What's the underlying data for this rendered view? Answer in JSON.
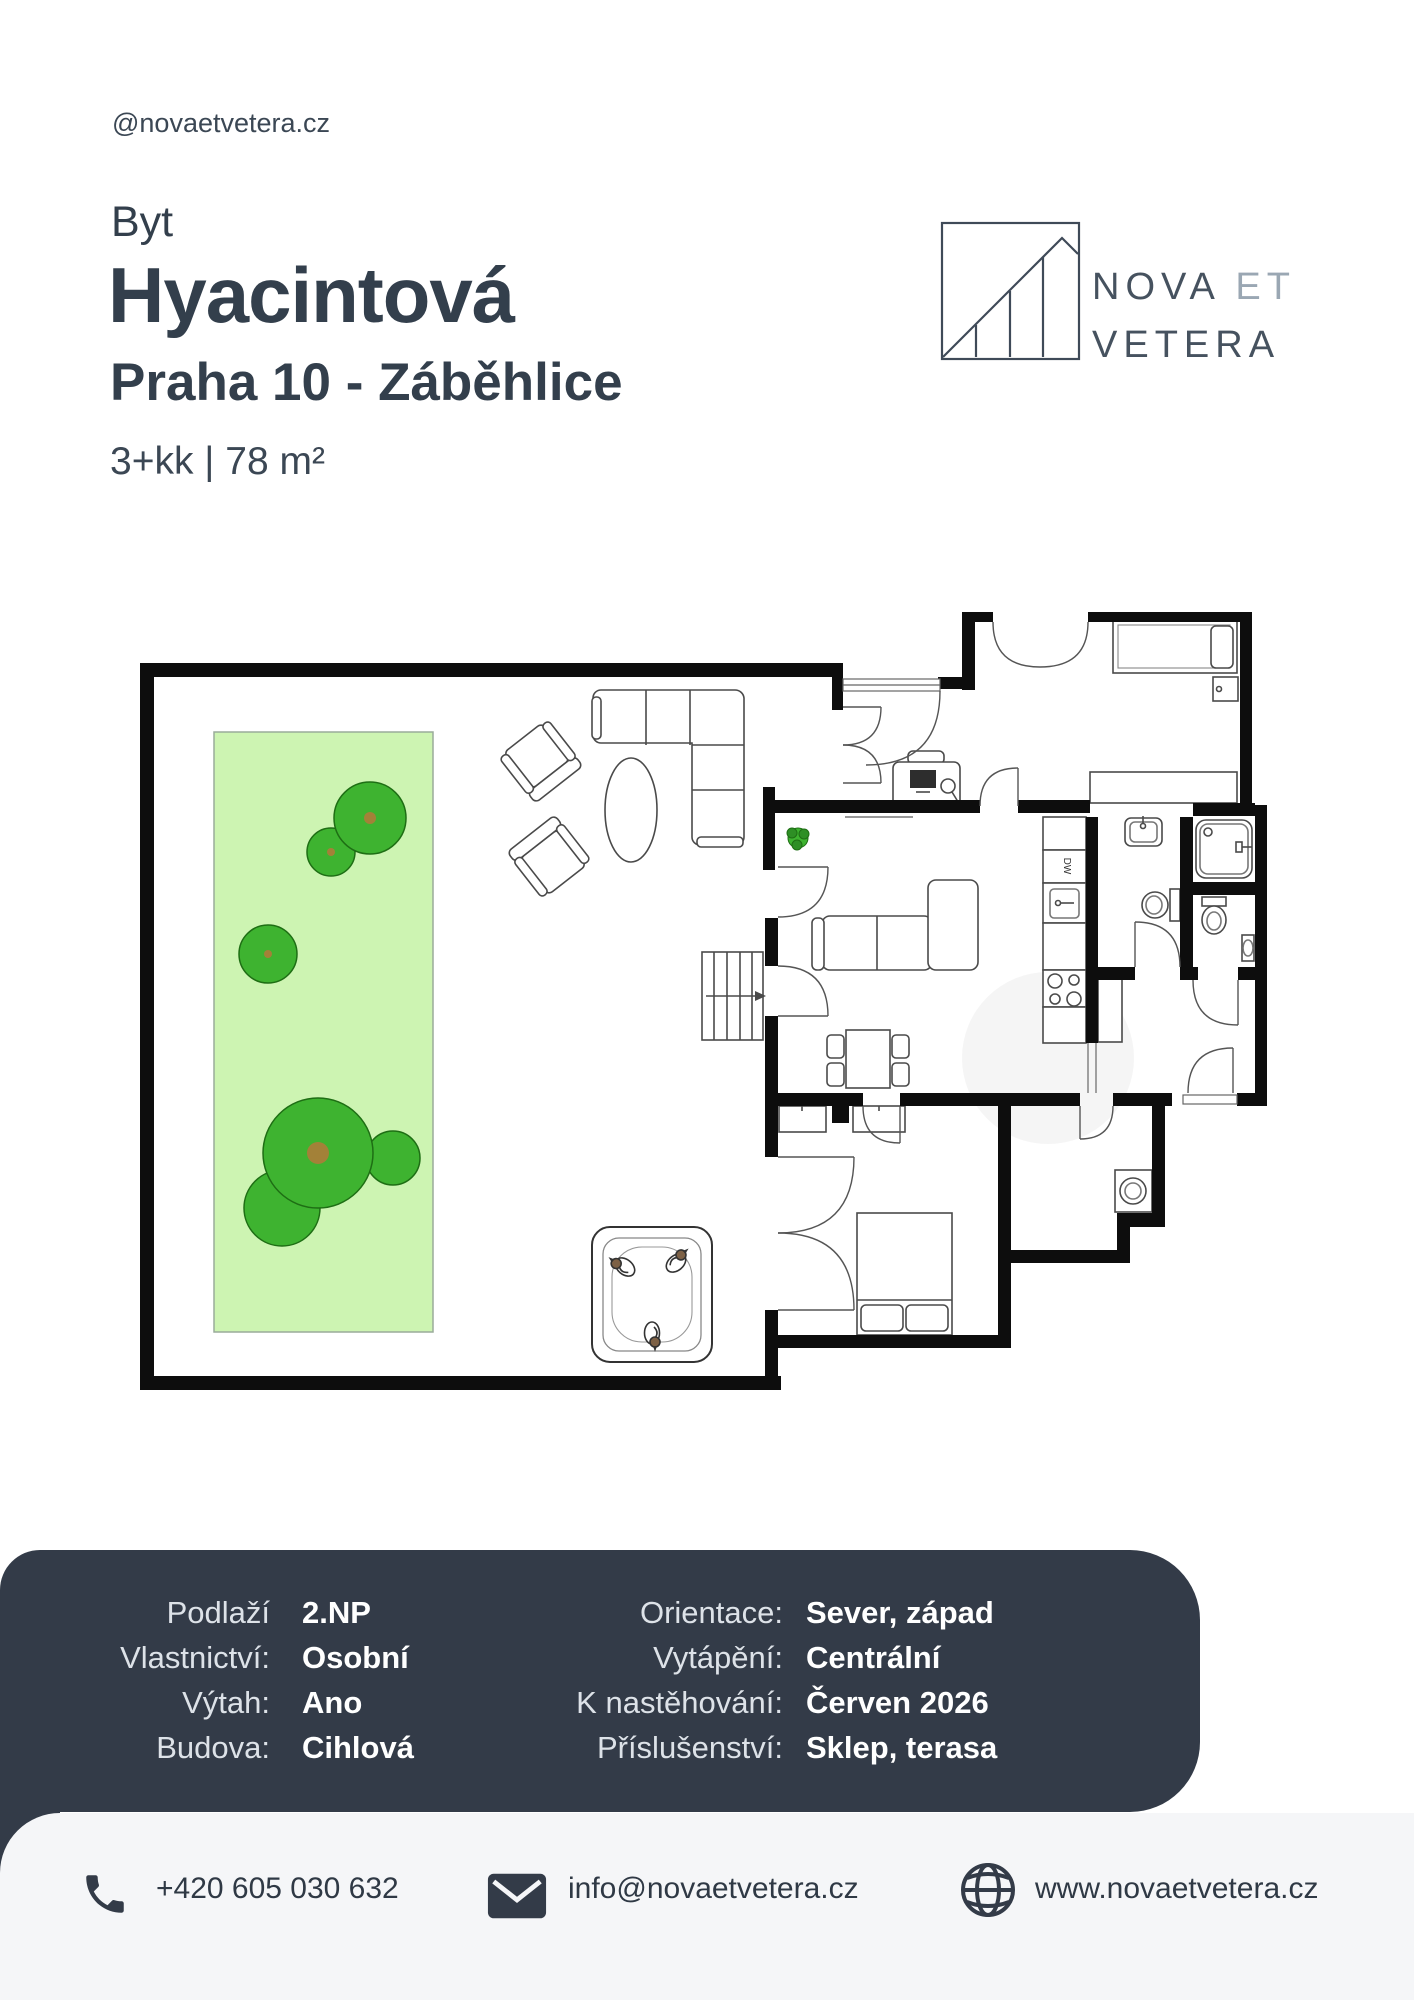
{
  "header": {
    "handle": "@novaetvetera.cz",
    "category": "Byt",
    "title": "Hyacintová",
    "subtitle": "Praha 10 - Záběhlice",
    "specs": "3+kk | 78 m²"
  },
  "logo": {
    "nova": "NOVA",
    "et": "ET",
    "vetera": "VETERA"
  },
  "details": {
    "left": [
      {
        "label": "Podlaží",
        "value": "2.NP"
      },
      {
        "label": "Vlastnictví:",
        "value": "Osobní"
      },
      {
        "label": "Výtah:",
        "value": "Ano"
      },
      {
        "label": "Budova:",
        "value": "Cihlová"
      }
    ],
    "right": [
      {
        "label": "Orientace:",
        "value": "Sever, západ"
      },
      {
        "label": "Vytápění:",
        "value": "Centrální"
      },
      {
        "label": "K nastěhování:",
        "value": "Červen 2026"
      },
      {
        "label": "Příslušenství:",
        "value": "Sklep, terasa"
      }
    ]
  },
  "contact": {
    "phone": "+420 605 030 632",
    "email": "info@novaetvetera.cz",
    "website": "www.novaetvetera.cz"
  },
  "floorplan": {
    "dw_label": "DW"
  },
  "colors": {
    "panel": "#333b48",
    "light_panel": "#f5f6f8",
    "ink": "#333f4c",
    "lawn": "#cdf4b2",
    "tree_green": "#3eb330",
    "logo_light": "#9aa7b3"
  }
}
